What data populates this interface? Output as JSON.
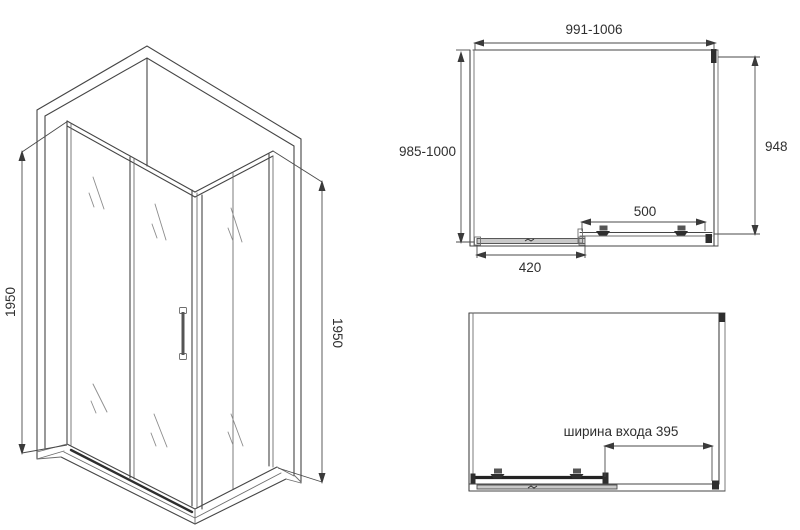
{
  "drawing": {
    "kind": "shower-enclosure-technical-drawing",
    "views": [
      "isometric-view",
      "plan-view-closed",
      "plan-view-open"
    ]
  },
  "iso_view": {
    "height_left_label": "1950",
    "height_right_label": "1950"
  },
  "top_view": {
    "width_label": "991-1006",
    "depth_label": "985-1000",
    "side_panel_label": "948",
    "door_label": "500",
    "fixed_panel_label": "420"
  },
  "open_view": {
    "entry_width_label": "ширина входа 395"
  },
  "colors": {
    "background": "#ffffff",
    "line": "#454545",
    "text": "#2f2f2f",
    "glass_mark": "#8c8c8c",
    "profile_dark": "#2e2e2e"
  }
}
